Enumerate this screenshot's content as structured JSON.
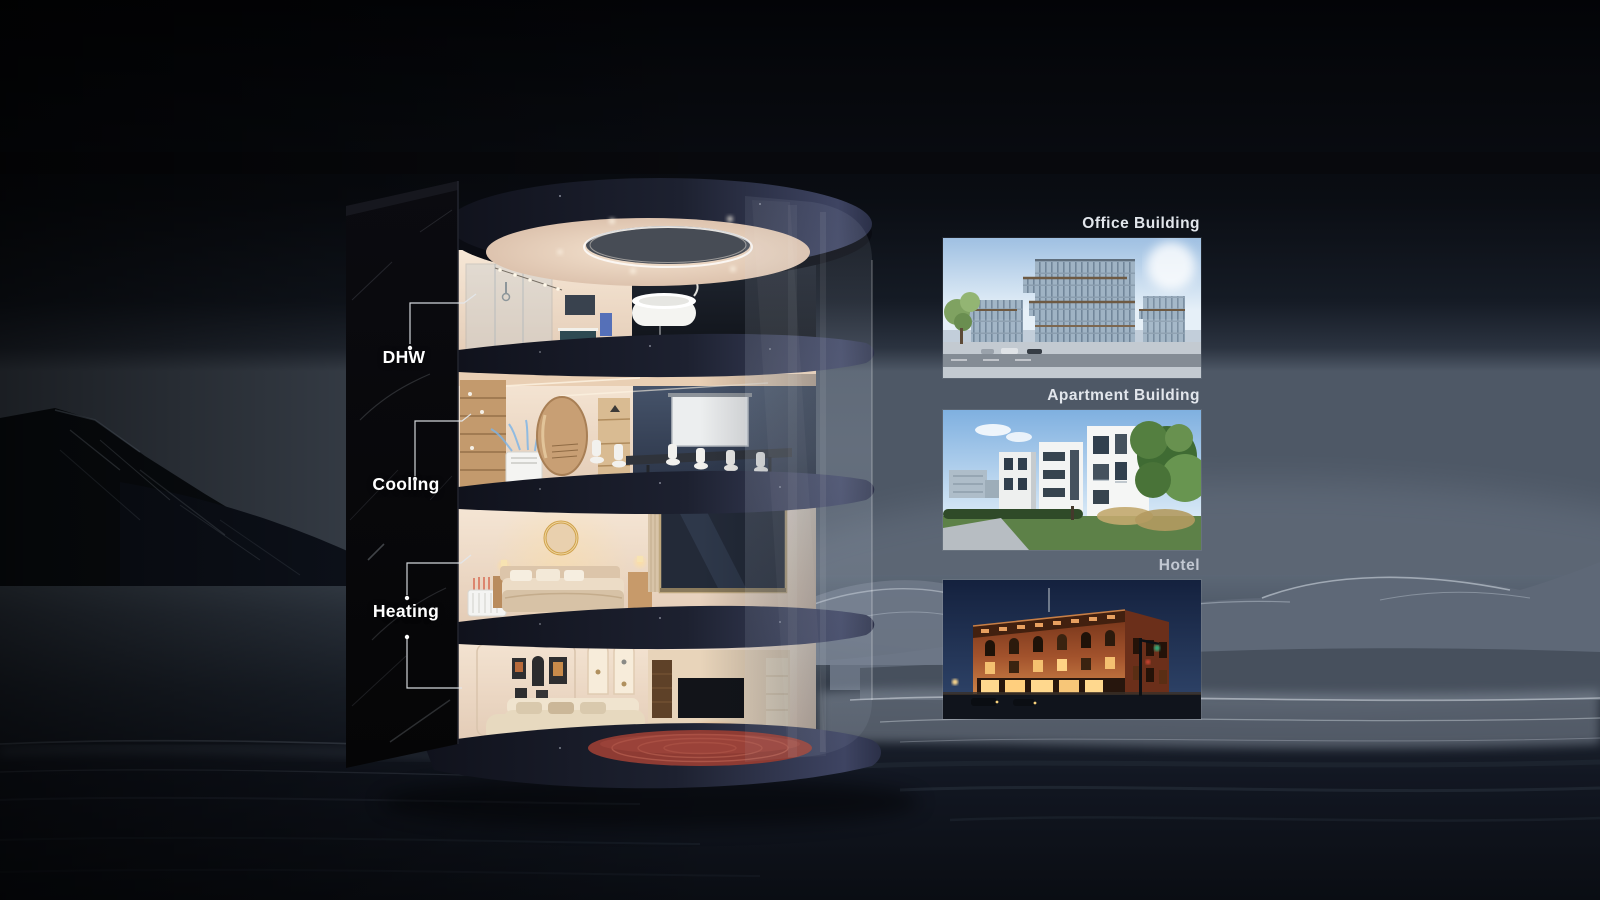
{
  "callouts": [
    {
      "id": "dhw",
      "label": "DHW"
    },
    {
      "id": "cooling",
      "label": "Cooling"
    },
    {
      "id": "heating",
      "label": "Heating"
    }
  ],
  "building_types": [
    {
      "id": "office-building",
      "label": "Office Building"
    },
    {
      "id": "apartment-building",
      "label": "Apartment Building"
    },
    {
      "id": "hotel",
      "label": "Hotel"
    }
  ],
  "colors": {
    "background_top": "#04050a",
    "horizon": "#5a6674",
    "label_text": "#ffffff",
    "photo_label": "#e2e6ec",
    "hotel_label": "#c2c8d2",
    "interior_warm": "#f0dcc6",
    "slab_dark": "#161a28",
    "slab_highlight": "#454a66",
    "marble_black": "#070709",
    "carpet_red": "#9c4036",
    "cooling_blue": "#6fb0e8",
    "glass_tint": "#cfdcec"
  }
}
